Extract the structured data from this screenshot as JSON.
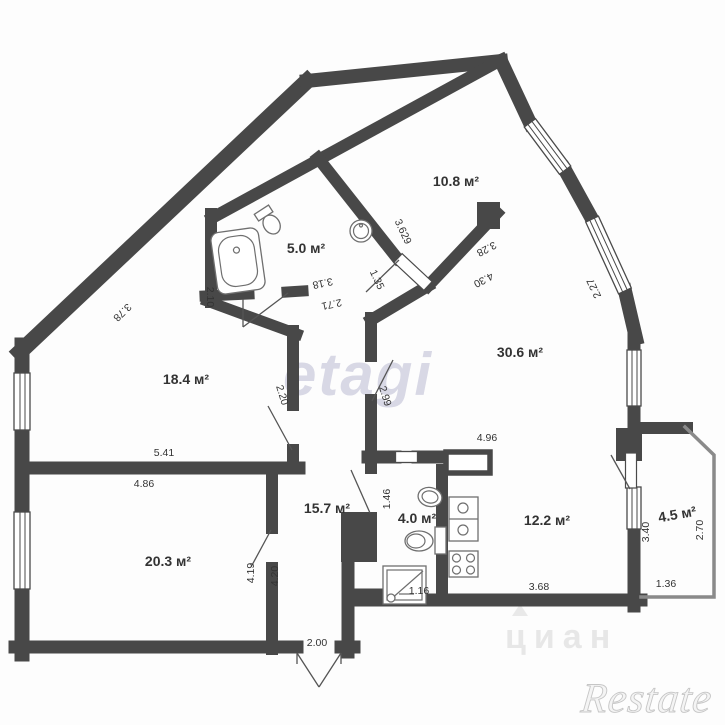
{
  "title": "apartment-floor-plan",
  "watermarks": {
    "center": "etagi",
    "faint": "циан",
    "corner": "Restate"
  },
  "colors": {
    "wall": "#484848",
    "fixture": "#6f6f6f",
    "text": "#333333",
    "wm_center": "#b4b4ce",
    "wm_faint": "#bdbdbd",
    "wm_corner": "#d9d9d9"
  },
  "rooms": [
    {
      "label": "10.8 м²",
      "x": 456,
      "y": 186,
      "rot": 0
    },
    {
      "label": "5.0 м²",
      "x": 306,
      "y": 253,
      "rot": 0
    },
    {
      "label": "18.4 м²",
      "x": 186,
      "y": 384,
      "rot": 0
    },
    {
      "label": "30.6 м²",
      "x": 520,
      "y": 357,
      "rot": 0
    },
    {
      "label": "20.3 м²",
      "x": 168,
      "y": 566,
      "rot": 0
    },
    {
      "label": "15.7 м²",
      "x": 327,
      "y": 513,
      "rot": 0
    },
    {
      "label": "4.0 м²",
      "x": 417,
      "y": 523,
      "rot": 0
    },
    {
      "label": "12.2 м²",
      "x": 547,
      "y": 525,
      "rot": 0
    },
    {
      "label": "4.5 м²",
      "x": 678,
      "y": 519,
      "rot": -10
    }
  ],
  "dimensions": [
    {
      "label": "3.78",
      "x": 120,
      "y": 310,
      "rot": 136
    },
    {
      "label": "2.10",
      "x": 207,
      "y": 297,
      "rot": 90
    },
    {
      "label": "3.18",
      "x": 322,
      "y": 280,
      "rot": 168
    },
    {
      "label": "2.71",
      "x": 331,
      "y": 301,
      "rot": 168
    },
    {
      "label": "1.35",
      "x": 374,
      "y": 281,
      "rot": 65
    },
    {
      "label": "3.629",
      "x": 400,
      "y": 233,
      "rot": 65
    },
    {
      "label": "3.28",
      "x": 485,
      "y": 246,
      "rot": 152
    },
    {
      "label": "4.30",
      "x": 482,
      "y": 277,
      "rot": 152
    },
    {
      "label": "2.27",
      "x": 597,
      "y": 287,
      "rot": 245
    },
    {
      "label": "2.20",
      "x": 279,
      "y": 396,
      "rot": 73
    },
    {
      "label": "2.99",
      "x": 382,
      "y": 397,
      "rot": 73
    },
    {
      "label": "5.41",
      "x": 164,
      "y": 456,
      "rot": 0
    },
    {
      "label": "4.86",
      "x": 144,
      "y": 487,
      "rot": 0
    },
    {
      "label": "4.96",
      "x": 487,
      "y": 441,
      "rot": 0
    },
    {
      "label": "4.19",
      "x": 254,
      "y": 573,
      "rot": -90
    },
    {
      "label": "4.20",
      "x": 278,
      "y": 576,
      "rot": -90
    },
    {
      "label": "1.46",
      "x": 390,
      "y": 499,
      "rot": -90
    },
    {
      "label": "1.16",
      "x": 419,
      "y": 594,
      "rot": 0
    },
    {
      "label": "2.00",
      "x": 317,
      "y": 646,
      "rot": 0
    },
    {
      "label": "3.68",
      "x": 539,
      "y": 590,
      "rot": 0
    },
    {
      "label": "1.36",
      "x": 666,
      "y": 587,
      "rot": 0
    },
    {
      "label": "3.40",
      "x": 649,
      "y": 532,
      "rot": -90
    },
    {
      "label": "2.70",
      "x": 703,
      "y": 530,
      "rot": -90
    }
  ]
}
